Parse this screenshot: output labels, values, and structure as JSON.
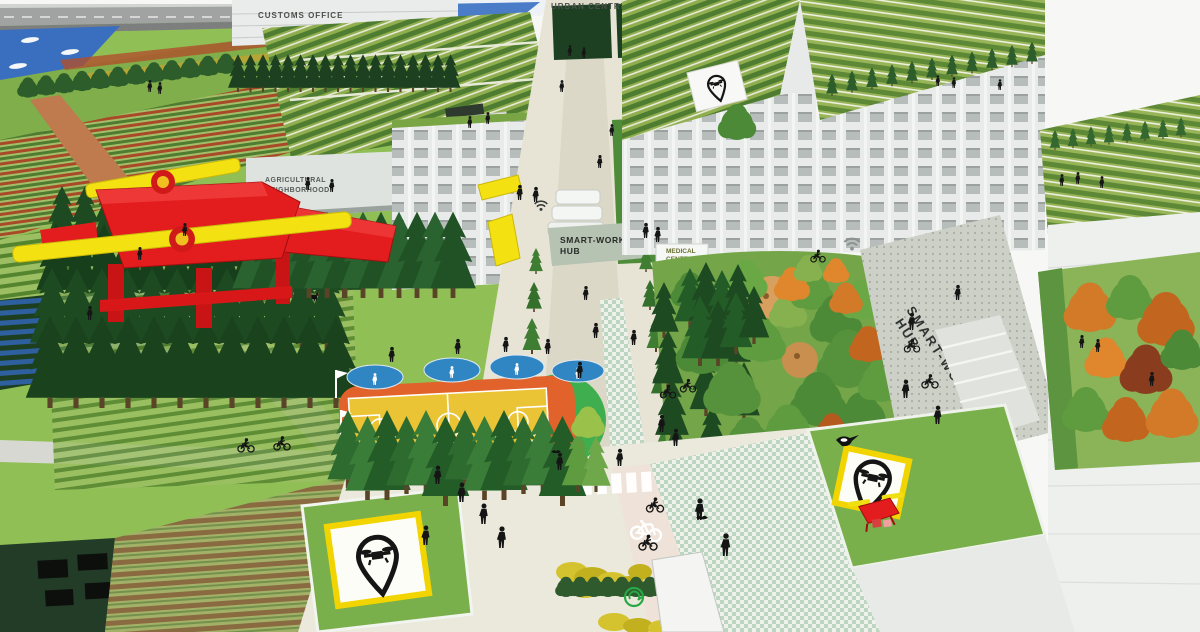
{
  "scene": {
    "labels": {
      "customs_office": "CUSTOMS OFFICE",
      "urban_centre": "URBAN CENTRE",
      "agricultural": [
        "AGRICULTURAL",
        "NEIGHBORHOOD"
      ],
      "hub": [
        "SMART-WORKING",
        "HUB"
      ],
      "medical": [
        "MEDICAL",
        "CENTER"
      ],
      "fab_lab": "FAB-LAB"
    },
    "icons": [
      {
        "name": "drone-pad-pin-icon",
        "meaning": "drone landing pad marker (map pin containing quadcopter)"
      },
      {
        "name": "wifi-icon",
        "meaning": "public wifi hotspot"
      },
      {
        "name": "red-cross-icon",
        "meaning": "medical center"
      },
      {
        "name": "bicycle-icon",
        "meaning": "bike lane pavement marking"
      },
      {
        "name": "eco-logo-icon",
        "meaning": "green mobility swirl logo on pavement"
      }
    ],
    "colors": {
      "drone_red": "#e31d1d",
      "propeller_yellow": "#f3e112",
      "pad_border_yellow": "#f2d500",
      "court_yellow": "#eac435",
      "court_orange": "#e2622b",
      "court_green": "#3fae4e",
      "fitness_blue": "#2f86c3",
      "water_blue": "#3a6fc0",
      "cross_red": "#e02424",
      "tree_dark_green": "#1d4a21",
      "field_green": "#8fbf55",
      "facade_gray": "#eceeeb",
      "fablab_text_gray": "#a8aeac"
    }
  }
}
